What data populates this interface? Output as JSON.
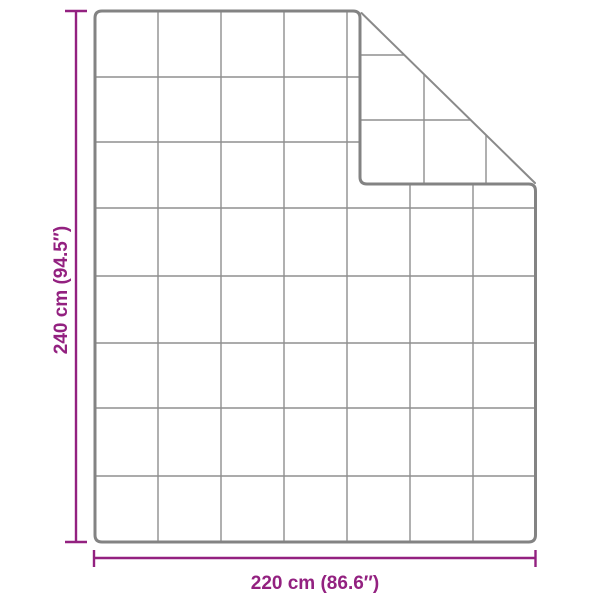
{
  "diagram": {
    "description": "Top view dimension diagram of a quilted blanket with its top-right corner folded over",
    "product_shape": "quilted-blanket",
    "grid": {
      "columns": 7,
      "rows": 8
    },
    "dimensions": {
      "height": {
        "value_cm": 240,
        "value_inch": 94.5,
        "label": "240 cm (94.5″)"
      },
      "width": {
        "value_cm": 220,
        "value_inch": 86.6,
        "label": "220 cm (86.6″)"
      }
    }
  },
  "colors": {
    "accent": "#932180",
    "outline": "#838383",
    "fold_edge": "#8a8a8a",
    "grid_line": "#8f8f8f",
    "background": "#ffffff"
  }
}
